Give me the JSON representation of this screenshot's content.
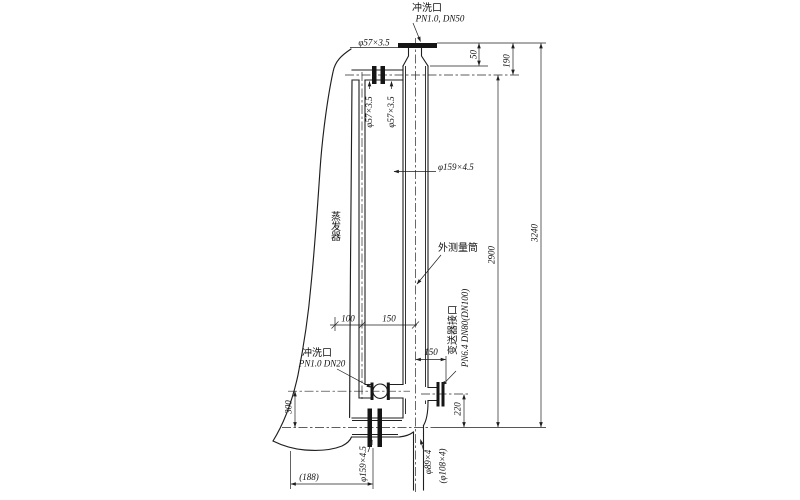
{
  "drawing": {
    "components": {
      "vessel": "蒸发器",
      "chamber": "外测量筒"
    },
    "ports": {
      "top_flush": {
        "label": "冲洗口",
        "spec": "PN1.0, DN50"
      },
      "bottom_flush": {
        "label": "冲洗口",
        "spec": "PN1.0 DN20"
      },
      "transmitter": {
        "label": "变送器接口",
        "spec": "PN6.4 DN80(DN100)"
      }
    },
    "pipe_sizes": {
      "top_nozzle": "φ57×3.5",
      "riser_left": "φ57×3.5",
      "riser_right": "φ57×3.5",
      "chamber_dia": "φ159×4.5",
      "bottom_pipe": "φ159×4.5",
      "drain": "φ89×4",
      "drain_alt": "(φ108×4)"
    },
    "dimensions": {
      "flange_to_cone": "50",
      "flange_to_top_pipe": "190",
      "pipe_to_pipe": "2900",
      "overall": "3240",
      "vessel_to_riser": "100",
      "riser_to_chamber": "150",
      "chamber_to_port_face": "150",
      "valve_height": "300",
      "port_height": "220",
      "bottom_offset": "(188)"
    }
  }
}
